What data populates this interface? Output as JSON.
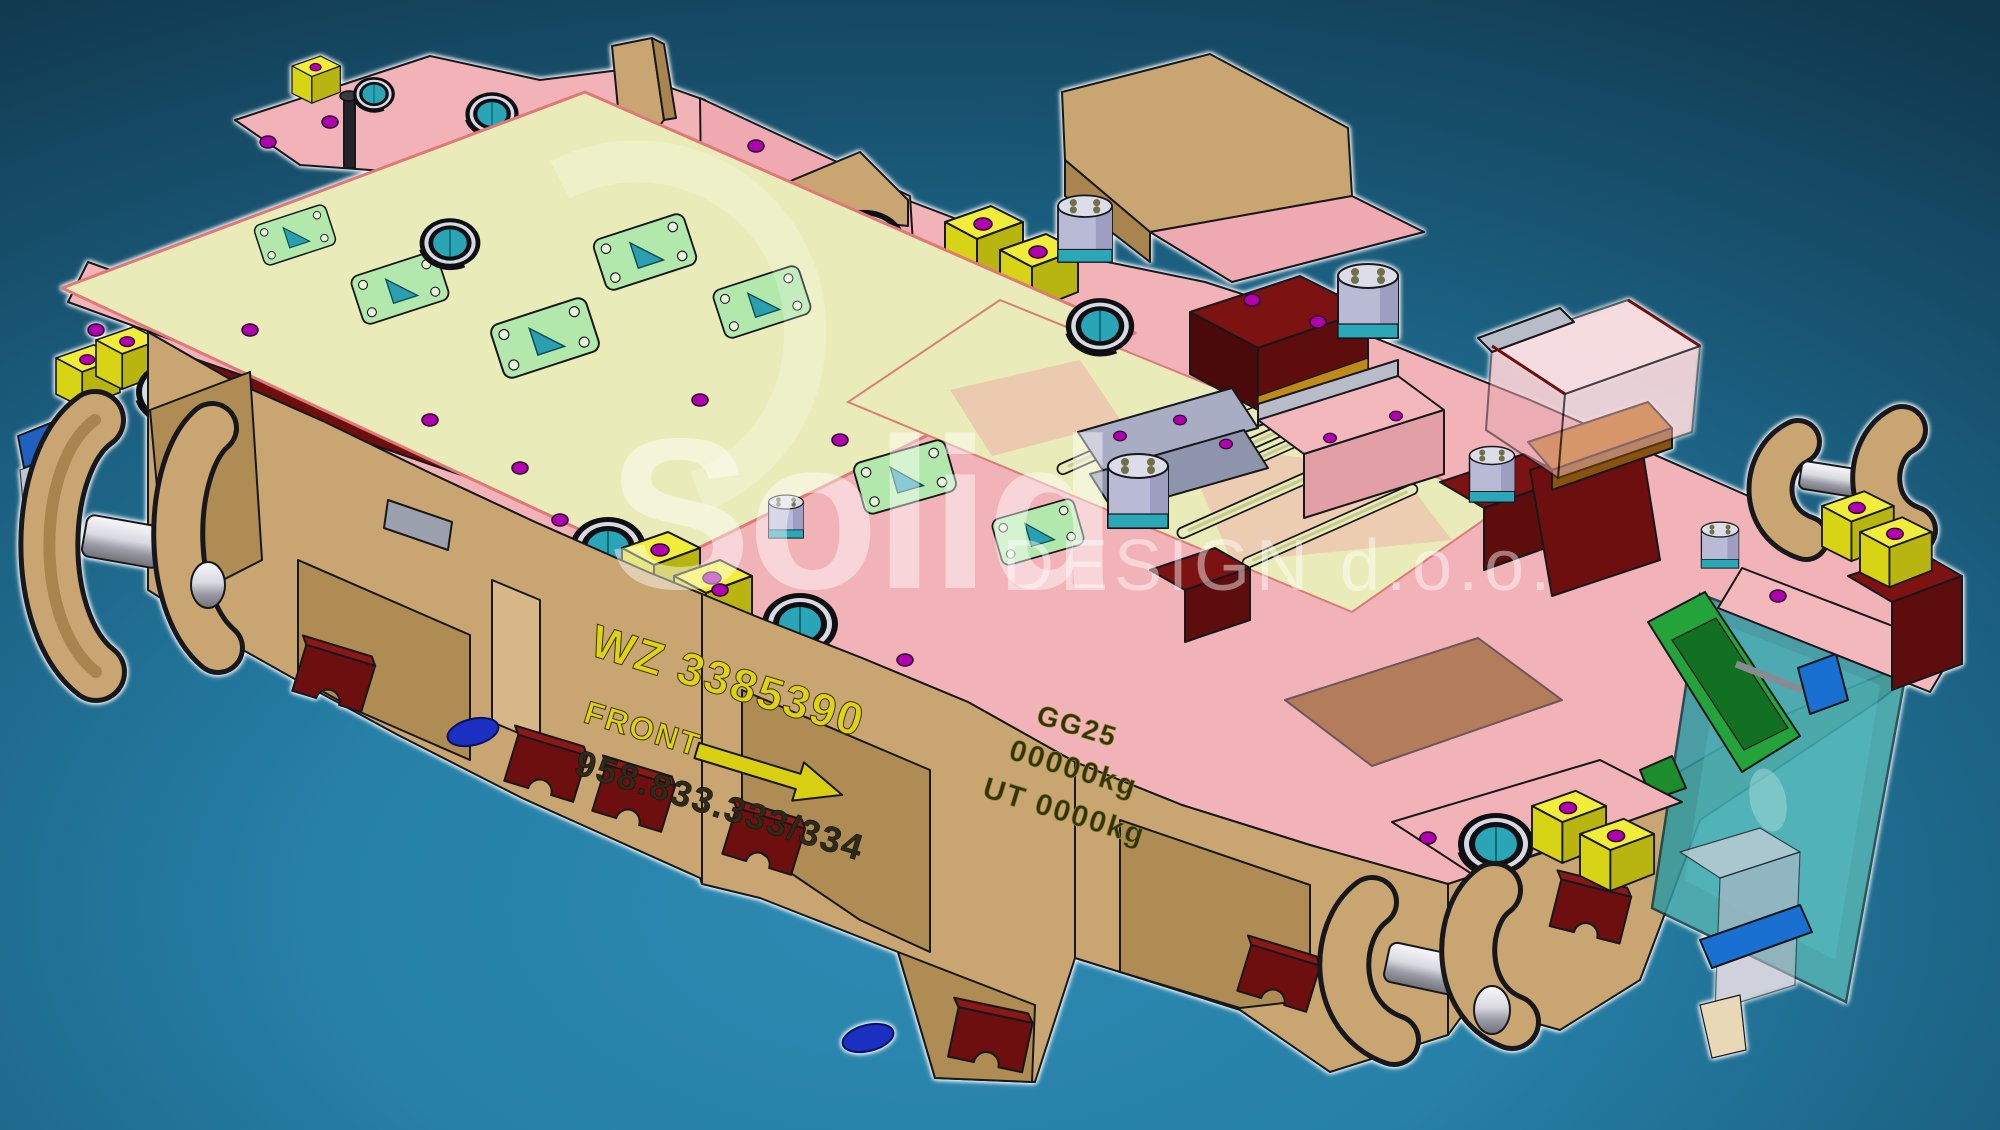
{
  "watermark": {
    "brand": "Solid",
    "company_suffix": "DESIGN d.o.o.",
    "color": "#ffffff"
  },
  "die_markings": {
    "tool_number": "WZ 3385390",
    "orientation_label": "FRONT",
    "reference_number": "958.833.333/334",
    "material_grade": "GG25",
    "weight_line": "00000kg",
    "upper_weight_line": "UT 0000kg",
    "marking_yellow": "#ded414",
    "marking_dark": "#2e2a1a"
  },
  "background": {
    "corner_dark": "#10364b",
    "center_glow": "#2e8ab2"
  },
  "palette": {
    "base_tan": "#c9a671",
    "base_tan_dark": "#b08c55",
    "plate_pink": "#f2b3b8",
    "plate_pink_dark": "#eba3ab",
    "sheet_yellow_green": "#e9ecb8",
    "gauge_plate_green": "#b2e8ac",
    "accent_maroon": "#7c1212",
    "safety_block_yellow": "#f0ee3a",
    "bushing_teal": "#2aa5b5",
    "scrap_chute_teal": "#2f9aa2",
    "conveyor_green": "#23a339",
    "screw_magenta": "#b000b0",
    "cylinder_lavender": "#b9bad6",
    "clamp_blue": "#1a70d0",
    "edge_outline": "#17171c",
    "silhouette_glow": "#ffffff"
  }
}
